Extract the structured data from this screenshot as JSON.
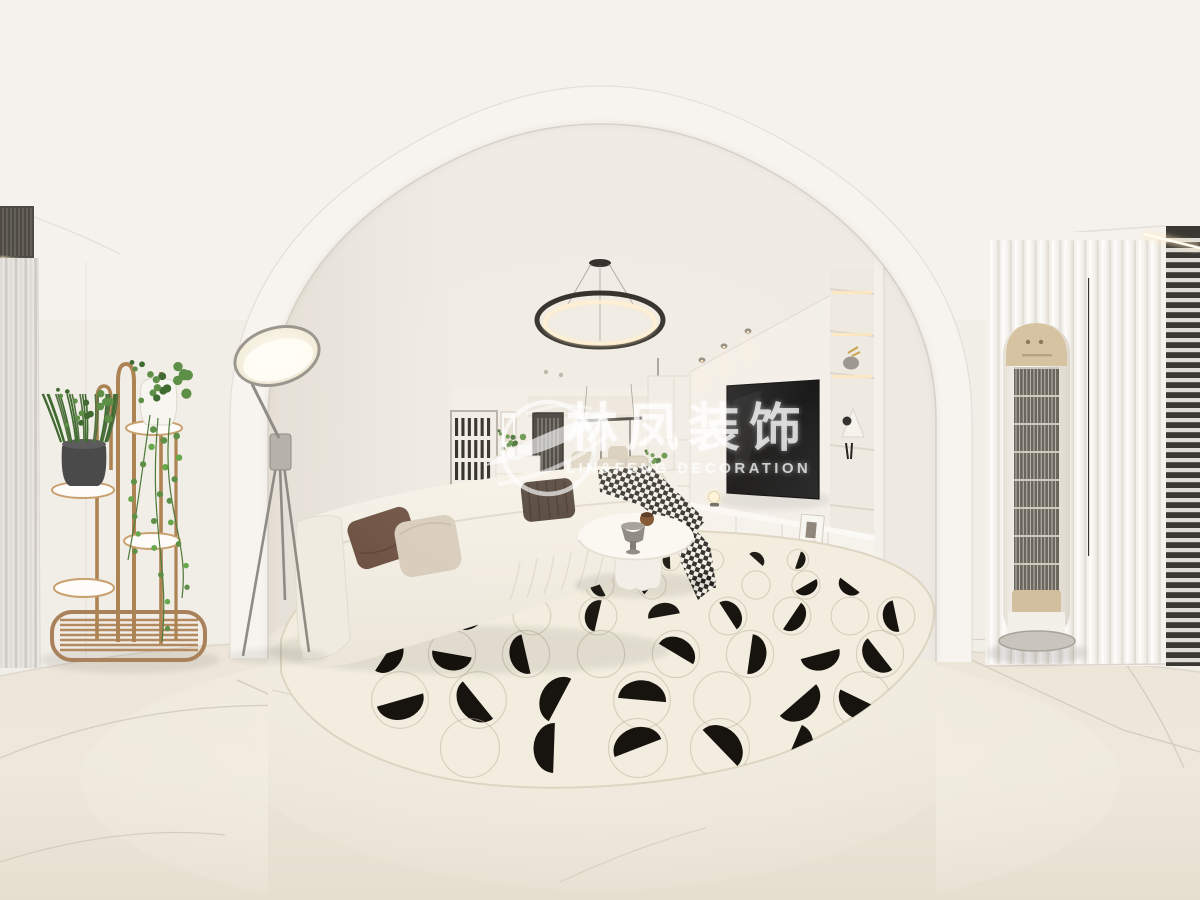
{
  "watermark": {
    "brand_cn": "林凤装饰",
    "brand_en": "LIN&FENG DECORATION",
    "logo": "phoenix-swoosh-in-circle"
  },
  "palette": {
    "ceiling": "#f4f1ed",
    "wall": "#efebe4",
    "arch_band": "#f7f4ef",
    "floor_light": "#efe9dd",
    "floor_dark": "#e3dccd",
    "rug": "#f2edde",
    "rug_motif_black": "#17140f",
    "rug_outline": "#b9b09a",
    "sofa_cream": "#f4f0e7",
    "pillow_brown": "#6e5244",
    "pillow_beige": "#d8cdbc",
    "pillow_dark": "#4d3f35",
    "tv_black": "#111111",
    "wood_brass": "#b08a5e",
    "plant_green": "#5d8f46",
    "plant_green_dark": "#3f6a30",
    "ac_champagne": "#d3c09e",
    "chandelier_black": "#2a2723",
    "led_warm": "#ffe9bd",
    "grille_dark": "#6a665e",
    "window_frame_dark": "#3b3833"
  }
}
